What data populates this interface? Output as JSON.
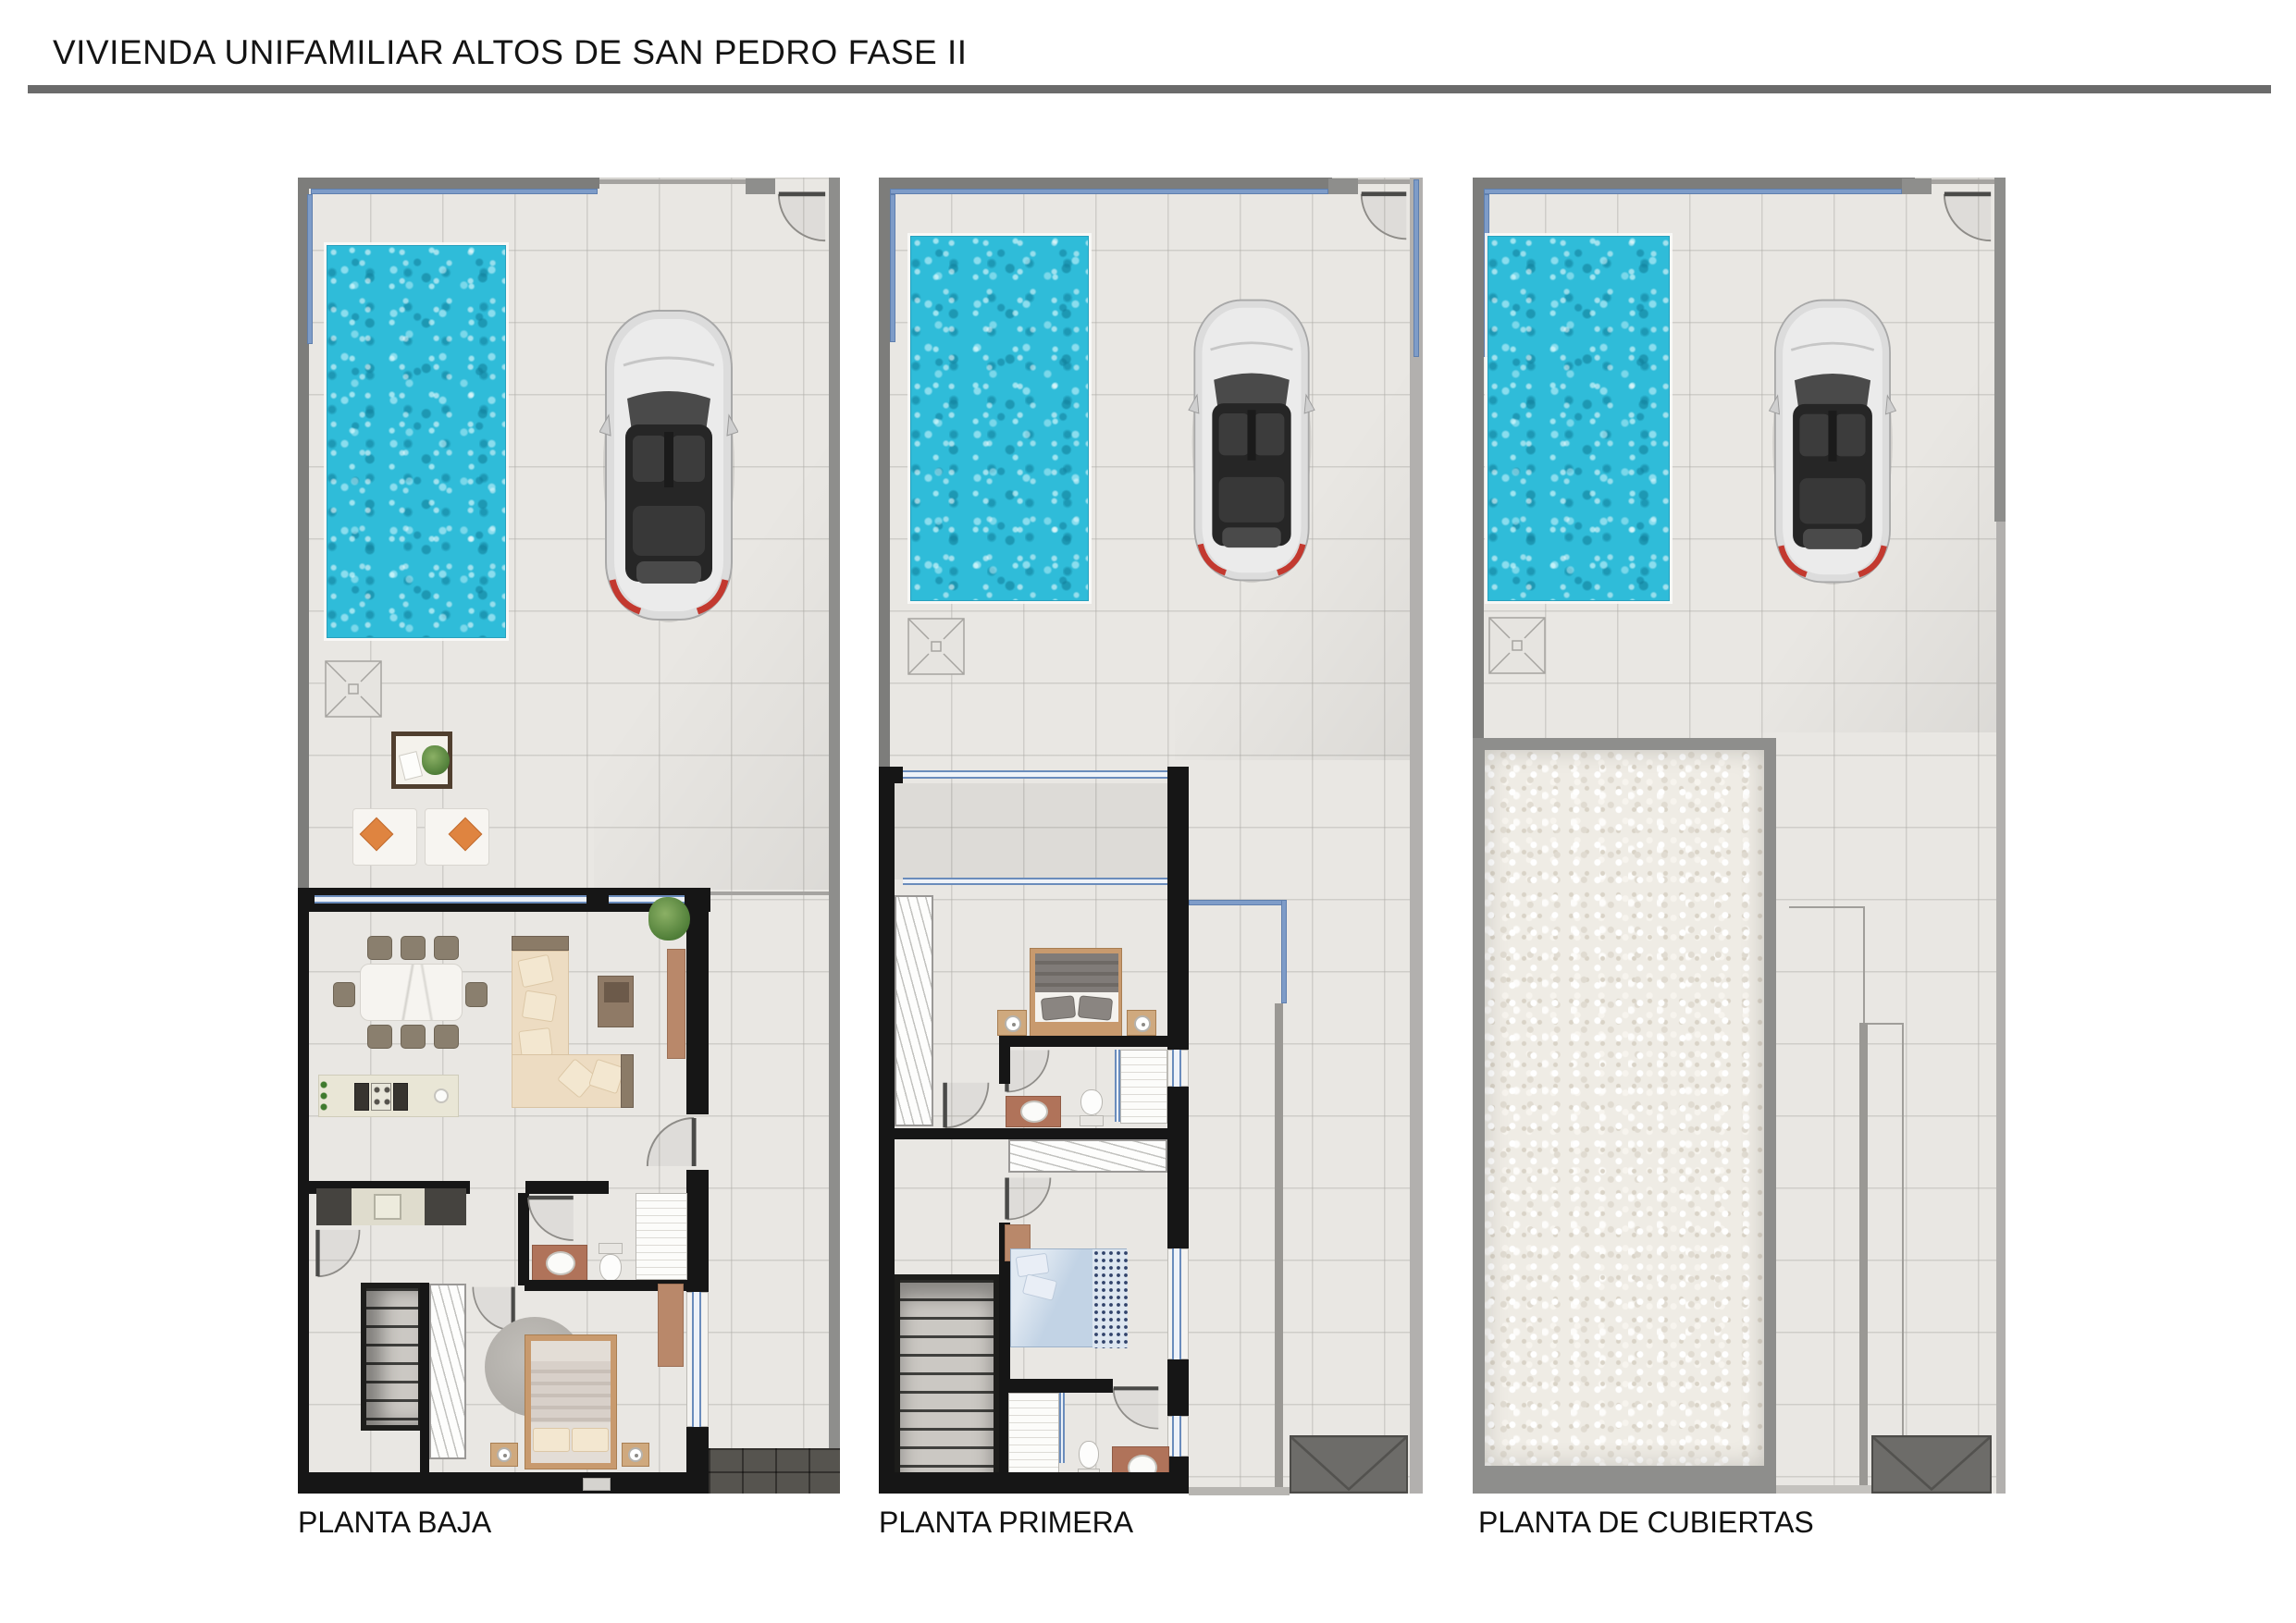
{
  "page": {
    "title": "VIVIENDA UNIFAMILIAR ALTOS DE SAN PEDRO FASE II",
    "sheet_type": "architectural floor plan presentation sheet"
  },
  "plans": [
    {
      "label": "PLANTA BAJA",
      "features": [
        "swimming-pool",
        "parked-car",
        "outdoor-shower-drain",
        "terrace-planter",
        "sun-loungers",
        "dining-table-8-chairs",
        "l-shaped-sofa",
        "coffee-table",
        "tv-sideboard",
        "indoor-plant",
        "kitchen-island",
        "kitchen-counter-sink",
        "bathroom-vanity",
        "toilet",
        "shower",
        "stairs",
        "wardrobe",
        "double-bed",
        "round-rug",
        "entrance-porch"
      ]
    },
    {
      "label": "PLANTA PRIMERA",
      "features": [
        "swimming-pool",
        "parked-car",
        "outdoor-shower-drain",
        "covered-terrace",
        "double-bed-gray",
        "wardrobe",
        "bathroom-1",
        "closet",
        "desk",
        "double-bed-blue",
        "stairs",
        "bathroom-2",
        "open-terrace",
        "glass-railing",
        "entrance-canopy"
      ]
    },
    {
      "label": "PLANTA DE CUBIERTAS",
      "features": [
        "swimming-pool",
        "parked-car",
        "outdoor-shower-drain",
        "gravel-flat-roof",
        "parapet",
        "roof-terrace",
        "entrance-canopy"
      ]
    }
  ],
  "icons": {
    "car": "car-top-view-icon",
    "drain": "floor-drain-icon",
    "door": "door-swing-icon",
    "plant": "plant-icon",
    "canopy": "entrance-canopy-icon"
  },
  "colors": {
    "pool_water": "#2fbcd9",
    "tile_floor": "#e9e7e3",
    "wall_black": "#161616",
    "wall_gray": "#7d7d7b",
    "wall_light_gray": "#b2b0ae",
    "glass_blue": "#6a8cbc",
    "gravel_roof": "#efece5",
    "canopy_gray": "#6d6c69",
    "porch_dark": "#56544f",
    "vanity_brown": "#b0735a",
    "wood_tan": "#c89a6e",
    "sofa_beige": "#eddcc2",
    "cushion_orange": "#df8440",
    "title_text": "#141414"
  }
}
